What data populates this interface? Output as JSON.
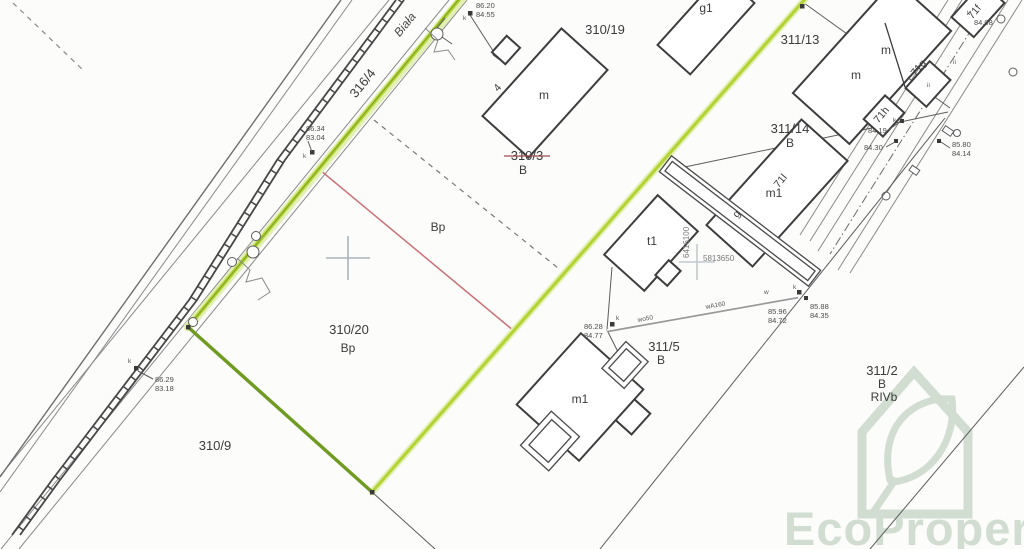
{
  "map": {
    "street": {
      "name": "Biała",
      "parcel": "316/4"
    },
    "parcels": {
      "p310_19": {
        "label": "310/19"
      },
      "p310_20": {
        "label": "310/20",
        "use": "Bp"
      },
      "p310_3": {
        "label": "310/3",
        "use": "B",
        "use2": "Bp"
      },
      "p310_9": {
        "label": "310/9"
      },
      "p311_13": {
        "label": "311/13"
      },
      "p311_14": {
        "label": "311/14",
        "use": "B"
      },
      "p311_5": {
        "label": "311/5",
        "use": "B"
      },
      "p311_2": {
        "label": "311/2",
        "use": "B",
        "soil": "RIVb"
      }
    },
    "buildings": {
      "house_m4": {
        "label": "m",
        "number": "4"
      },
      "g1": {
        "label": "g1"
      },
      "duplex": {
        "label_left": "m",
        "label_right": "m"
      },
      "b71f": {
        "label": "71f"
      },
      "b71g": {
        "label": "71g"
      },
      "b71h": {
        "label": "71h"
      },
      "b71l": {
        "label": "71l",
        "type": "m1"
      },
      "garage": {
        "label": "g"
      },
      "t1": {
        "label": "t1"
      },
      "house_m1": {
        "label": "m1"
      }
    },
    "elevations": {
      "road_top": {
        "upper": "86.20",
        "lower": "84.55"
      },
      "road_mid": {
        "upper": "86.34",
        "lower": "83.04"
      },
      "road_bottom": {
        "upper": "86.29",
        "lower": "83.18"
      },
      "right_top": {
        "upper": "84.08"
      },
      "right_a": {
        "upper": "84.19"
      },
      "right_b": {
        "upper": "84.30"
      },
      "right_c": {
        "upper": "85.80",
        "lower": "84.14"
      },
      "junction_a": {
        "upper": "85.96",
        "lower": "84.72"
      },
      "junction_b": {
        "upper": "85.88",
        "lower": "84.35"
      },
      "junction_c": {
        "upper": "86.28",
        "lower": "84.77"
      }
    },
    "grid": {
      "northing": "5813650",
      "easting": "6416100"
    },
    "annotations": {
      "k": "k",
      "w": "w",
      "ii": "ii",
      "pipe_a": "wA160",
      "pipe_b": "wo50"
    }
  },
  "watermark": {
    "brand": "EcoProperty"
  },
  "colors": {
    "highlight": "#b5d335",
    "highlight_dark": "#6f9b22",
    "highlight_halo": "#e3f0b4",
    "red_line": "#cc7077",
    "red_label": "#c04249",
    "maroon_label": "#9c4a4e",
    "watermark": "#d2ddd2"
  }
}
